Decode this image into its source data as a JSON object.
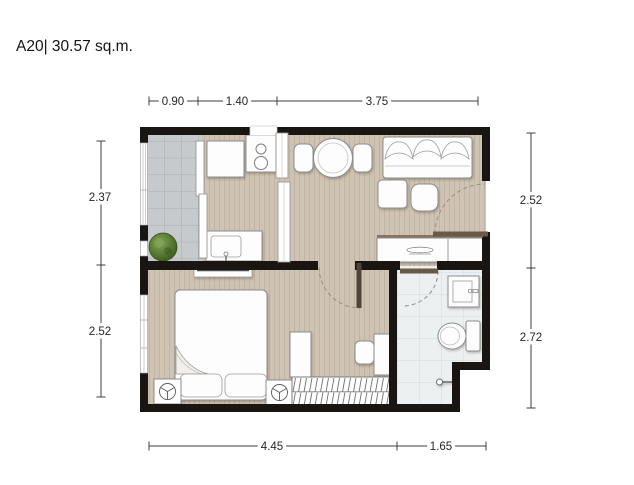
{
  "title": "A20| 30.57 sq.m.",
  "dimensions": {
    "top": [
      "0.90",
      "1.40",
      "3.75"
    ],
    "left": [
      "2.37",
      "2.52"
    ],
    "right": [
      "2.52",
      "2.72"
    ],
    "bottom": [
      "4.45",
      "1.65"
    ]
  },
  "colors": {
    "wall": "#181512",
    "wood_floor": "#cfc3b3",
    "balcony_tile": "#c6cacc",
    "bathroom_tile": "#edf0f1",
    "door_leaf": "#6b5947",
    "plant": "#53772f"
  }
}
